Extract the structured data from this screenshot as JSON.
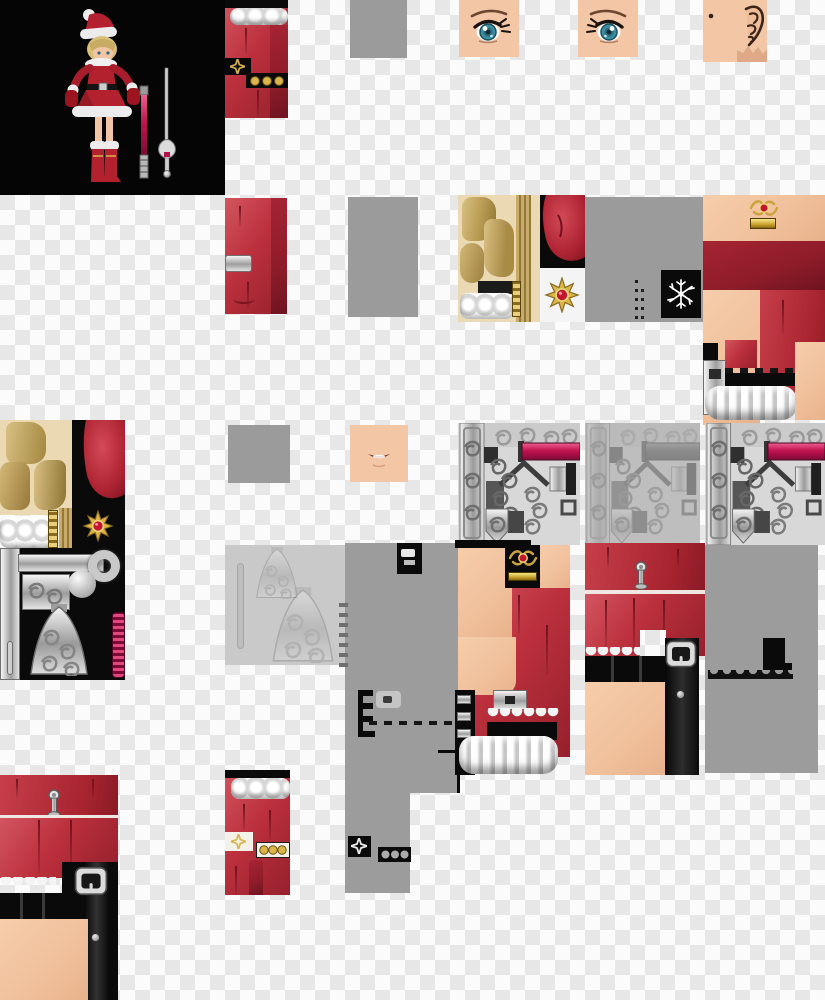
{
  "image": {
    "kind": "game character texture atlas with 3D preview render",
    "subject": "santa-outfit girl character skin and sword textures on transparency checkerboard",
    "width": 825,
    "height": 1000
  },
  "palette": {
    "checker_light": "#fbfbfb",
    "checker_dark": "#e7e7e7",
    "neutral_gray": "#9b9b9b",
    "red_fabric": "#bc303d",
    "red_dark": "#8e1c29",
    "skin": "#f2c6a4",
    "hair_gold": "#c9ab66",
    "hair_bg": "#ead9b2",
    "fur_white": "#f0f0f0",
    "gold": "#d9b54a",
    "gem_red": "#c3152f",
    "magenta": "#c2134f",
    "metal_light": "#e3e3e3",
    "metal_dark": "#6f6f6f",
    "black": "#0a0a0a",
    "eye_iris": "#3e8ca0",
    "preview_bg": "#050505"
  },
  "patches": [
    {
      "name": "character-preview",
      "x": 0,
      "y": 0,
      "w": 225,
      "h": 195
    },
    {
      "name": "red-sleeve-texture-top",
      "x": 225,
      "y": 0,
      "w": 63,
      "h": 118
    },
    {
      "name": "gray-filler-1",
      "x": 350,
      "y": 0,
      "w": 57,
      "h": 58
    },
    {
      "name": "eye-texture-left",
      "x": 459,
      "y": 0,
      "w": 60,
      "h": 57
    },
    {
      "name": "eye-texture-right",
      "x": 578,
      "y": 0,
      "w": 60,
      "h": 57
    },
    {
      "name": "ear-texture",
      "x": 703,
      "y": 0,
      "w": 64,
      "h": 62
    },
    {
      "name": "red-cuff-texture",
      "x": 225,
      "y": 198,
      "w": 62,
      "h": 116
    },
    {
      "name": "gray-filler-2",
      "x": 348,
      "y": 197,
      "w": 70,
      "h": 120
    },
    {
      "name": "hair-texture",
      "x": 458,
      "y": 195,
      "w": 82,
      "h": 127
    },
    {
      "name": "red-bulge-ornament",
      "x": 540,
      "y": 195,
      "w": 45,
      "h": 127
    },
    {
      "name": "gray-filler-3",
      "x": 585,
      "y": 197,
      "w": 118,
      "h": 125
    },
    {
      "name": "torso-texture-right",
      "x": 703,
      "y": 195,
      "w": 122,
      "h": 230
    },
    {
      "name": "hair-sword-texture-left",
      "x": 0,
      "y": 420,
      "w": 125,
      "h": 260
    },
    {
      "name": "gray-filler-4",
      "x": 228,
      "y": 425,
      "w": 62,
      "h": 58
    },
    {
      "name": "mouth-texture",
      "x": 350,
      "y": 425,
      "w": 58,
      "h": 57
    },
    {
      "name": "sword-guard-texture-1",
      "x": 458,
      "y": 423,
      "w": 122,
      "h": 122
    },
    {
      "name": "sword-guard-texture-faded",
      "x": 585,
      "y": 423,
      "w": 115,
      "h": 122
    },
    {
      "name": "sword-guard-texture-2",
      "x": 705,
      "y": 423,
      "w": 120,
      "h": 122
    },
    {
      "name": "faded-guard-texture",
      "x": 225,
      "y": 545,
      "w": 125,
      "h": 120
    },
    {
      "name": "gray-block-upper",
      "x": 345,
      "y": 543,
      "w": 113,
      "h": 250
    },
    {
      "name": "gray-block-lower",
      "x": 345,
      "y": 780,
      "w": 65,
      "h": 113
    },
    {
      "name": "dress-texture-a",
      "x": 455,
      "y": 540,
      "w": 115,
      "h": 235
    },
    {
      "name": "dress-texture-b",
      "x": 585,
      "y": 543,
      "w": 120,
      "h": 232
    },
    {
      "name": "gray-block-right",
      "x": 705,
      "y": 545,
      "w": 113,
      "h": 228
    },
    {
      "name": "dress-texture-c",
      "x": 0,
      "y": 775,
      "w": 118,
      "h": 225
    },
    {
      "name": "boot-texture",
      "x": 225,
      "y": 770,
      "w": 65,
      "h": 125
    }
  ]
}
